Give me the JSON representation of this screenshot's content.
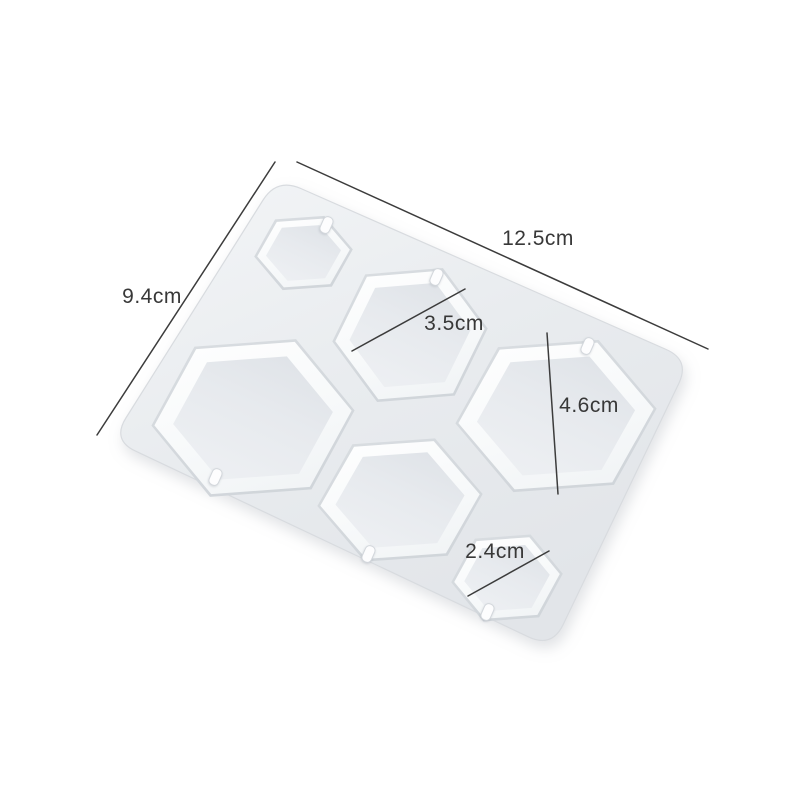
{
  "scene": {
    "type": "product-photo",
    "subject": "white silicone resin mold with six hexagonal pendant cavities",
    "background_color": "#ffffff"
  },
  "mold": {
    "body_color": "#e9ecef",
    "rim_color": "#fbfcfd",
    "cavity_floor_color": "#e7eaee",
    "cavity_count": 6,
    "peg_count": 6
  },
  "dimensions": {
    "line_color": "#3c3c3c",
    "text_color": "#383838",
    "overall_width": {
      "label": "12.5cm"
    },
    "overall_height": {
      "label": "9.4cm"
    },
    "medium_hexagon": {
      "label": "3.5cm"
    },
    "large_hexagon": {
      "label": "4.6cm"
    },
    "small_hexagon": {
      "label": "2.4cm"
    }
  }
}
